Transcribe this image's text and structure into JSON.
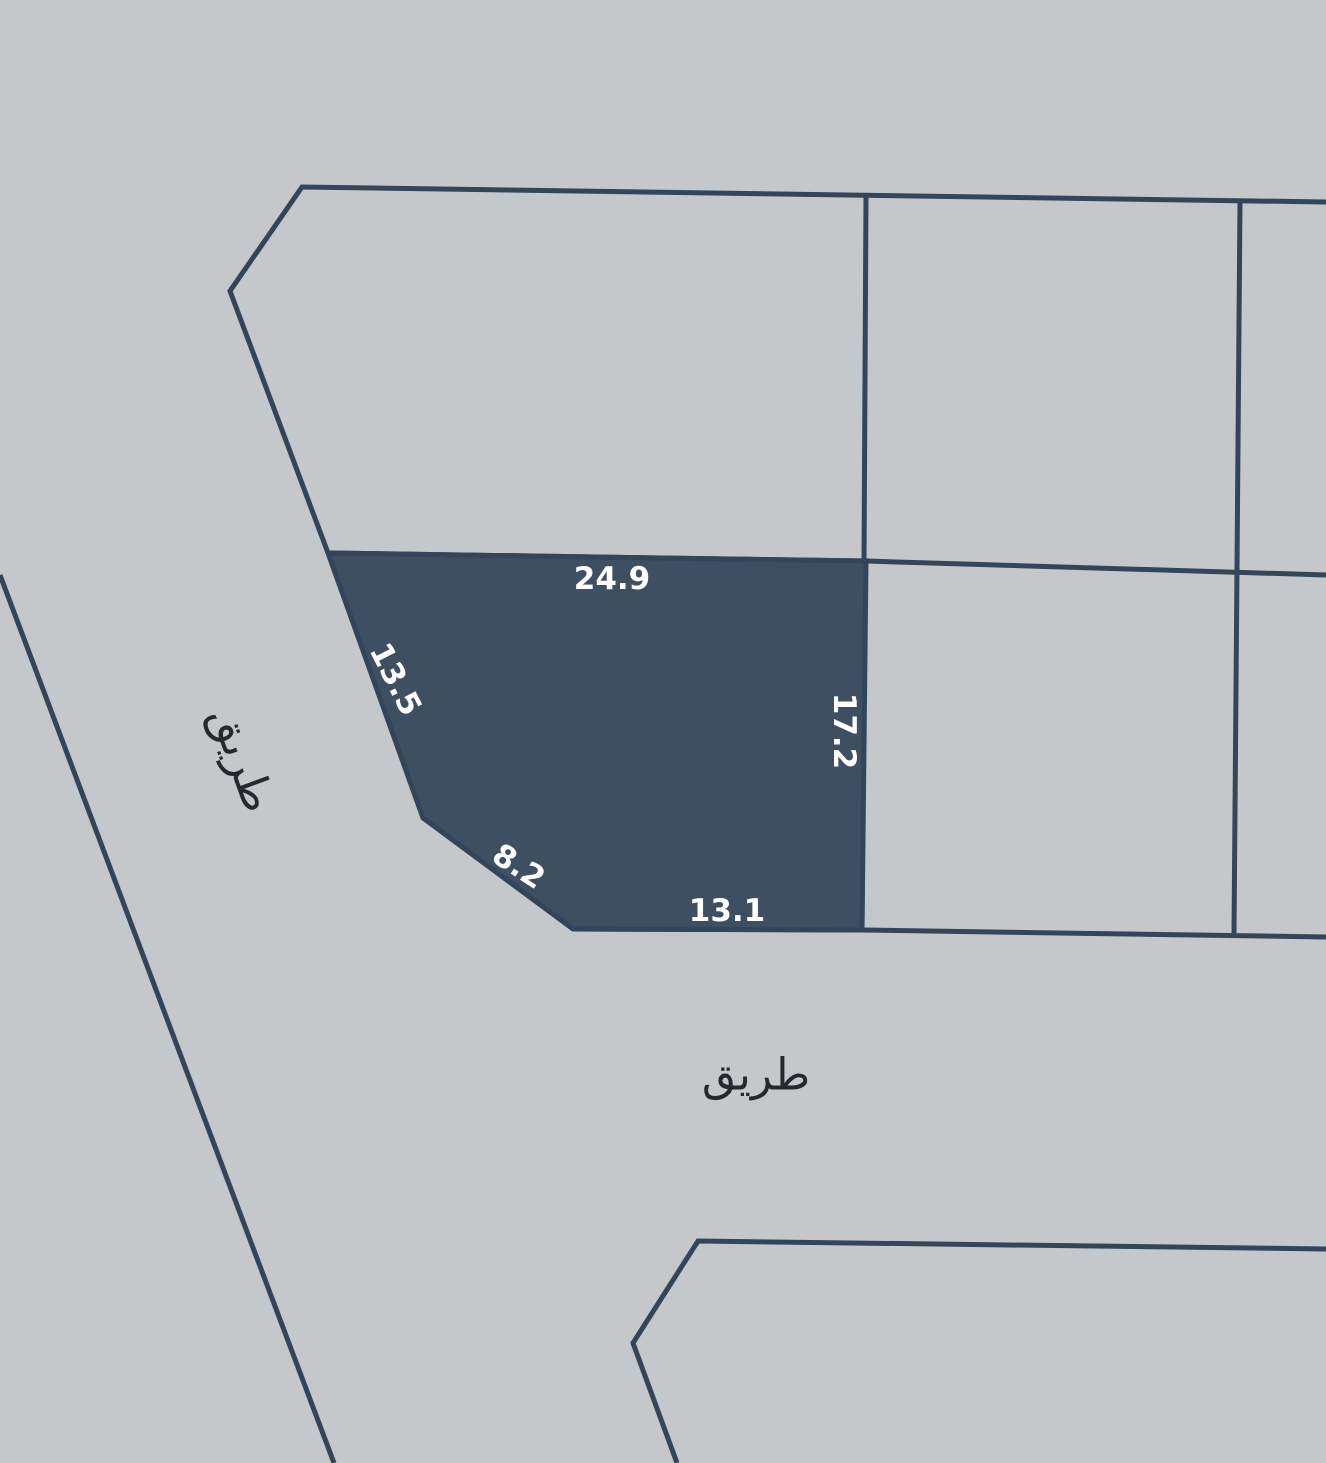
{
  "map": {
    "selected_parcel": {
      "dimensions": {
        "top": "24.9",
        "left": "13.5",
        "right": "17.2",
        "chamfer": "8.2",
        "bottom": "13.1"
      }
    },
    "road_labels": {
      "west": "طريق",
      "south": "طريق"
    },
    "colors": {
      "background": "#c4c8cb",
      "parcel_fill": "#3e4f62",
      "boundary_line": "#32455a",
      "dimension_text": "#ffffff",
      "road_text": "#25282c"
    }
  }
}
